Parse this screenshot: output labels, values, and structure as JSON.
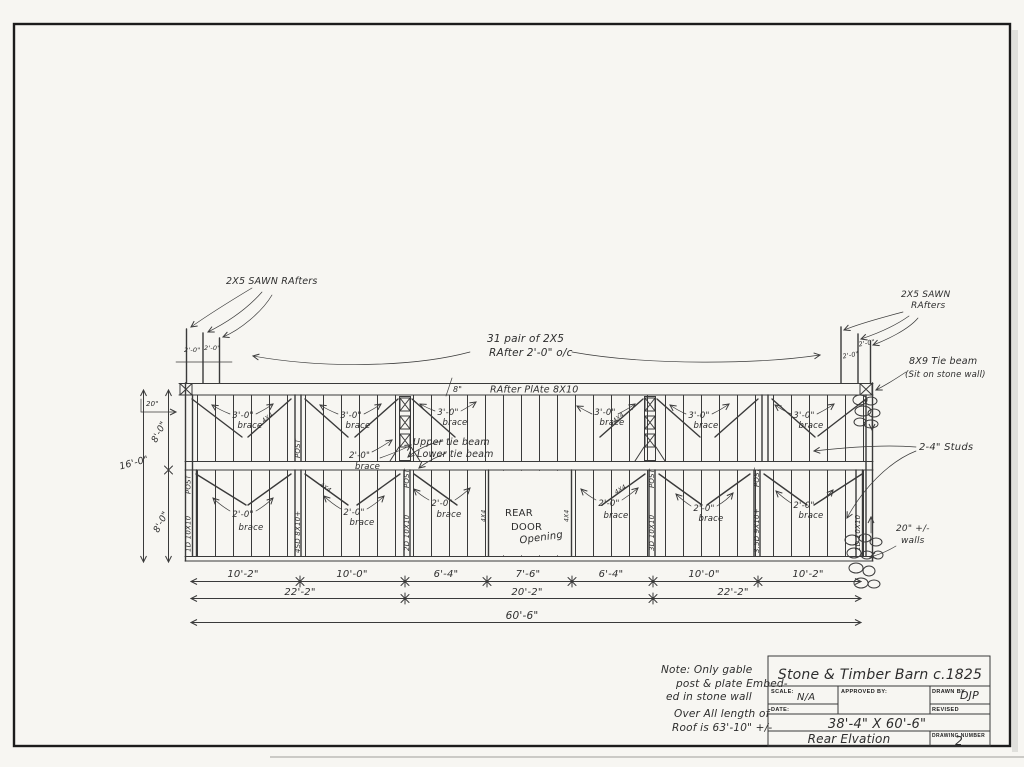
{
  "drawing": {
    "paper": "#f7f6f2",
    "ink": "#3a3a3a",
    "labels": {
      "rafters_left": "2X5 SAWN RAfters",
      "rafters_right_1": "2X5 SAWN",
      "rafters_right_2": "RAfters",
      "pair_note_1": "31 pair of 2X5",
      "pair_note_2": "RAfter 2'-0\" o/c",
      "plate": "RAfter PlAte 8X10",
      "plate_height": "8\"",
      "two_ft": "2'-0\"",
      "three_ft": "3'-0\"",
      "brace_word": "brace",
      "upper_tie": "Upper tie beam",
      "lower_tie": "Lower tie beam",
      "door_1": "REAR",
      "door_2": "DOOR",
      "door_3": "Opening",
      "tie_beam_1": "8X9 Tie beam",
      "tie_beam_2": "(Sit on stone wall)",
      "studs": "2-4\" Studs",
      "walls_1": "20\" +/-",
      "walls_2": "walls",
      "wall_20": "20\"",
      "post": "POST",
      "post_1": "1D 10X10",
      "post_2": "4SD 8X10+",
      "post_3": "2D 10X10",
      "post_4": "3D 10X10",
      "post_5": "3.5D 9X10+",
      "post_6": "1D 10X10",
      "jamb_size": "4X4",
      "brace_size": "4X4"
    },
    "dimensions": {
      "row1": [
        "10'-2\"",
        "10'-0\"",
        "6'-4\"",
        "7'-6\"",
        "6'-4\"",
        "10'-0\"",
        "10'-2\""
      ],
      "row2": [
        "22'-2\"",
        "20'-2\"",
        "22'-2\""
      ],
      "total": "60'-6\"",
      "height_total": "16'-0\"",
      "height_upper": "8'-0\"",
      "height_lower": "8'-0\""
    },
    "note": {
      "l1": "Note: Only gable",
      "l2": "post & plate Embed-",
      "l3": "ed in stone wall",
      "l4": "Over All length of",
      "l5": "Roof is 63'-10\" +/-"
    },
    "titleblock": {
      "title": "Stone & Timber Barn c.1825",
      "scale_label": "SCALE:",
      "scale_value": "N/A",
      "approved_label": "APPROVED BY:",
      "drawn_label": "DRAWN BY",
      "drawn_value": "DJP",
      "date_label": "DATE:",
      "revised_label": "REVISED",
      "overall_dims": "38'-4\" X 60'-6\"",
      "view_name": "Rear Elvation",
      "number_label": "DRAWING NUMBER",
      "number_value": "2"
    }
  }
}
